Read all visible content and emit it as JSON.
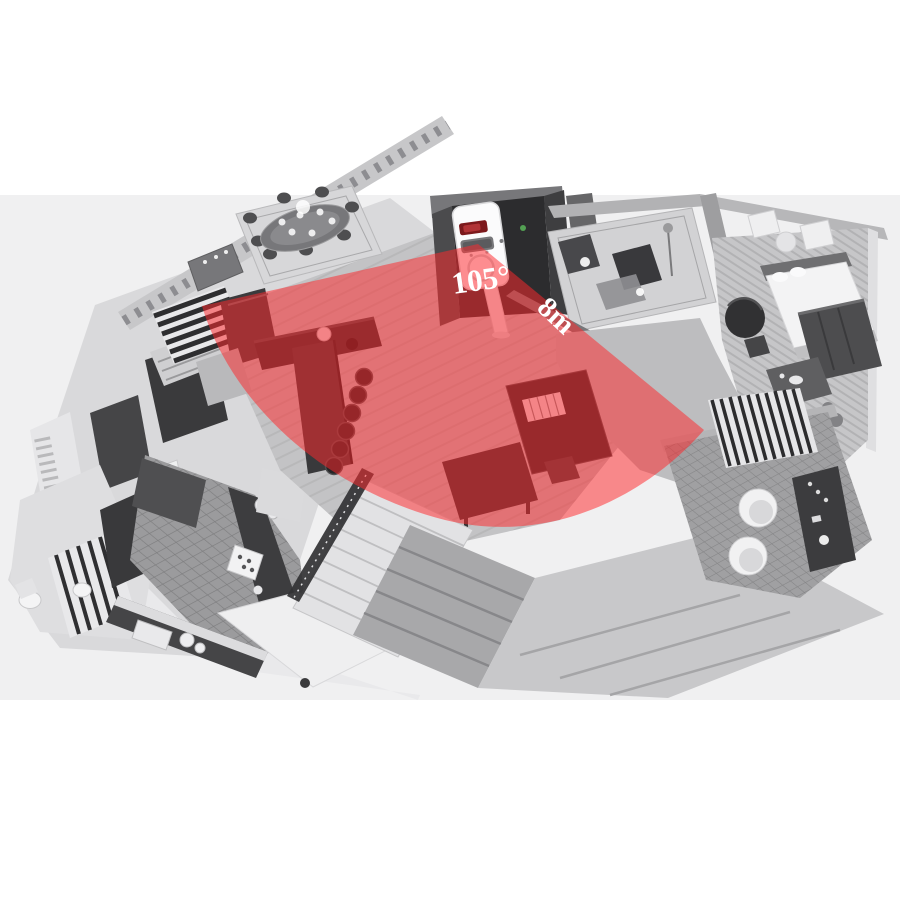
{
  "page": {
    "background": "#ffffff",
    "backdrop_band": "#f0f0f1"
  },
  "overlay": {
    "angle_label": "105°",
    "range_label": "8m",
    "cone_color": "#ff282d",
    "text_color": "#ffffff"
  },
  "sensor": {
    "led_color": "#7c191c",
    "body_color": "#fbfbfc"
  }
}
